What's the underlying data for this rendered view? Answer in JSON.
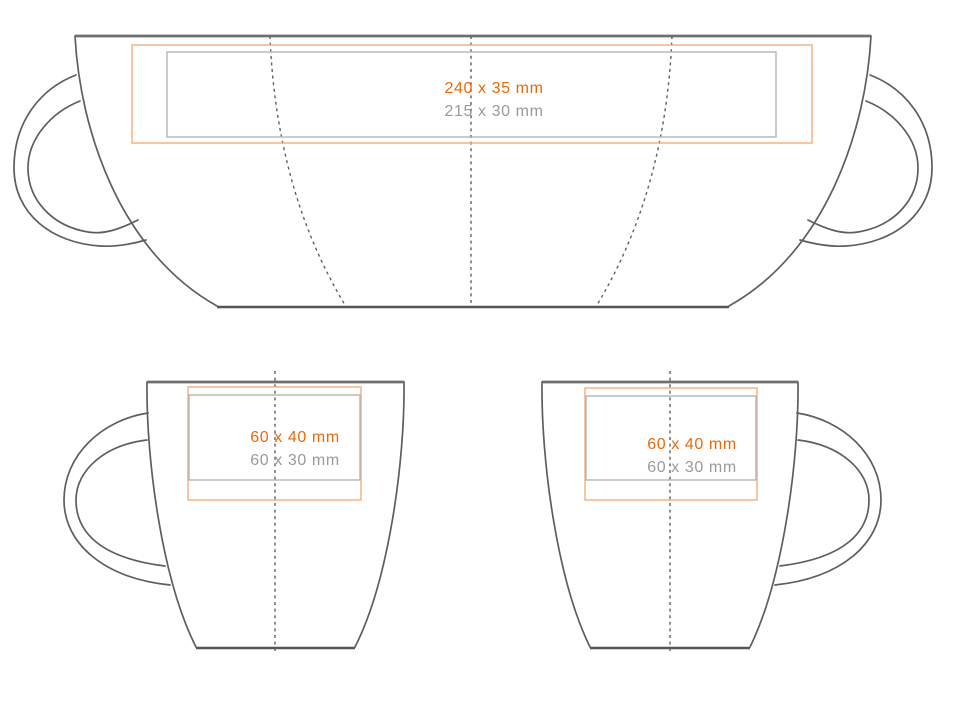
{
  "colors": {
    "accent_orange": "#e8690b",
    "orange_border": "#f3ae7c",
    "gray_text": "#9a9a9a",
    "gray_border": "#b5b5b5",
    "outline_gray": "#5d5e60",
    "rim_gray": "#6f6f6f",
    "base_gray": "#565656",
    "dash_gray": "#606060"
  },
  "wrap_view": {
    "max_area": "240 x 35 mm",
    "safe_area": "215 x 30 mm"
  },
  "front_view_left": {
    "max_area": "60 x 40 mm",
    "safe_area": "60 x 30 mm"
  },
  "front_view_right": {
    "max_area": "60 x 40 mm",
    "safe_area": "60 x 30 mm"
  }
}
